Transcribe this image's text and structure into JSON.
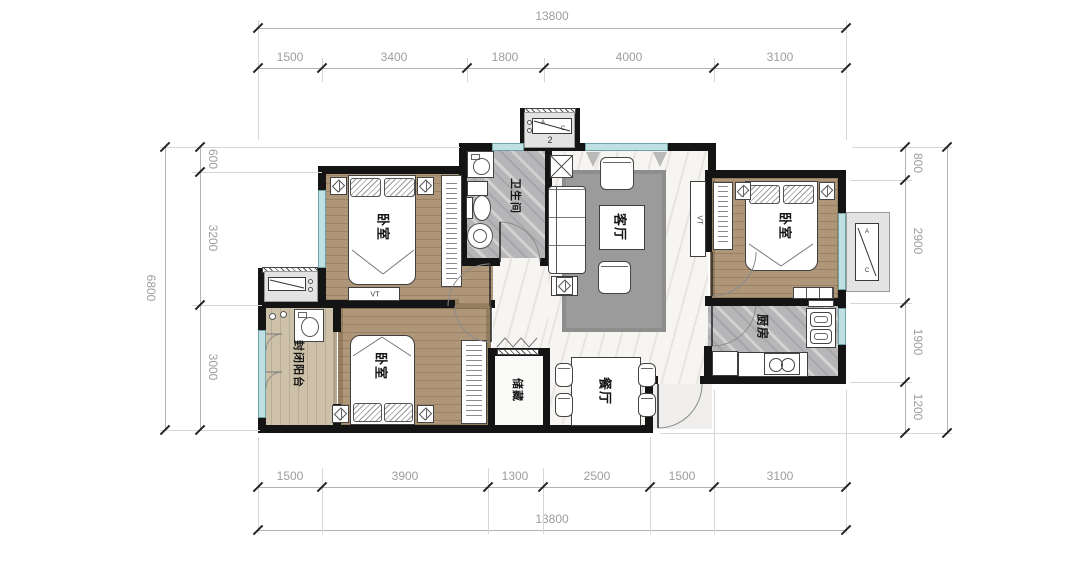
{
  "rooms": {
    "bedroom_top_left": "卧室",
    "bathroom": "卫生间",
    "living": "客厅",
    "bedroom_top_right": "卧室",
    "kitchen": "厨房",
    "balcony": "封闭阳台",
    "bedroom_bottom": "卧室",
    "storage": "储藏",
    "dining": "餐厅"
  },
  "annotations": {
    "tv": "VT",
    "ac_a": "A",
    "ac_c": "C",
    "bay_number": "2"
  },
  "dimensions": {
    "top": {
      "total": "13800",
      "segments": [
        "1500",
        "3400",
        "1800",
        "4000",
        "3100"
      ]
    },
    "bottom": {
      "total": "13800",
      "segments": [
        "1500",
        "3900",
        "1300",
        "2500",
        "1500",
        "3100"
      ]
    },
    "left": {
      "total": "6800",
      "segments": [
        "600",
        "3200",
        "3000"
      ]
    },
    "right": {
      "segments": [
        "800",
        "2900",
        "1900",
        "1200"
      ]
    }
  },
  "colors": {
    "wall": "#141414",
    "window": "#bfe0e2",
    "wood": "#af9678",
    "tile": "#b6b6b8",
    "marble": "#f6f5f2",
    "dim_text": "#9d9d9d"
  }
}
